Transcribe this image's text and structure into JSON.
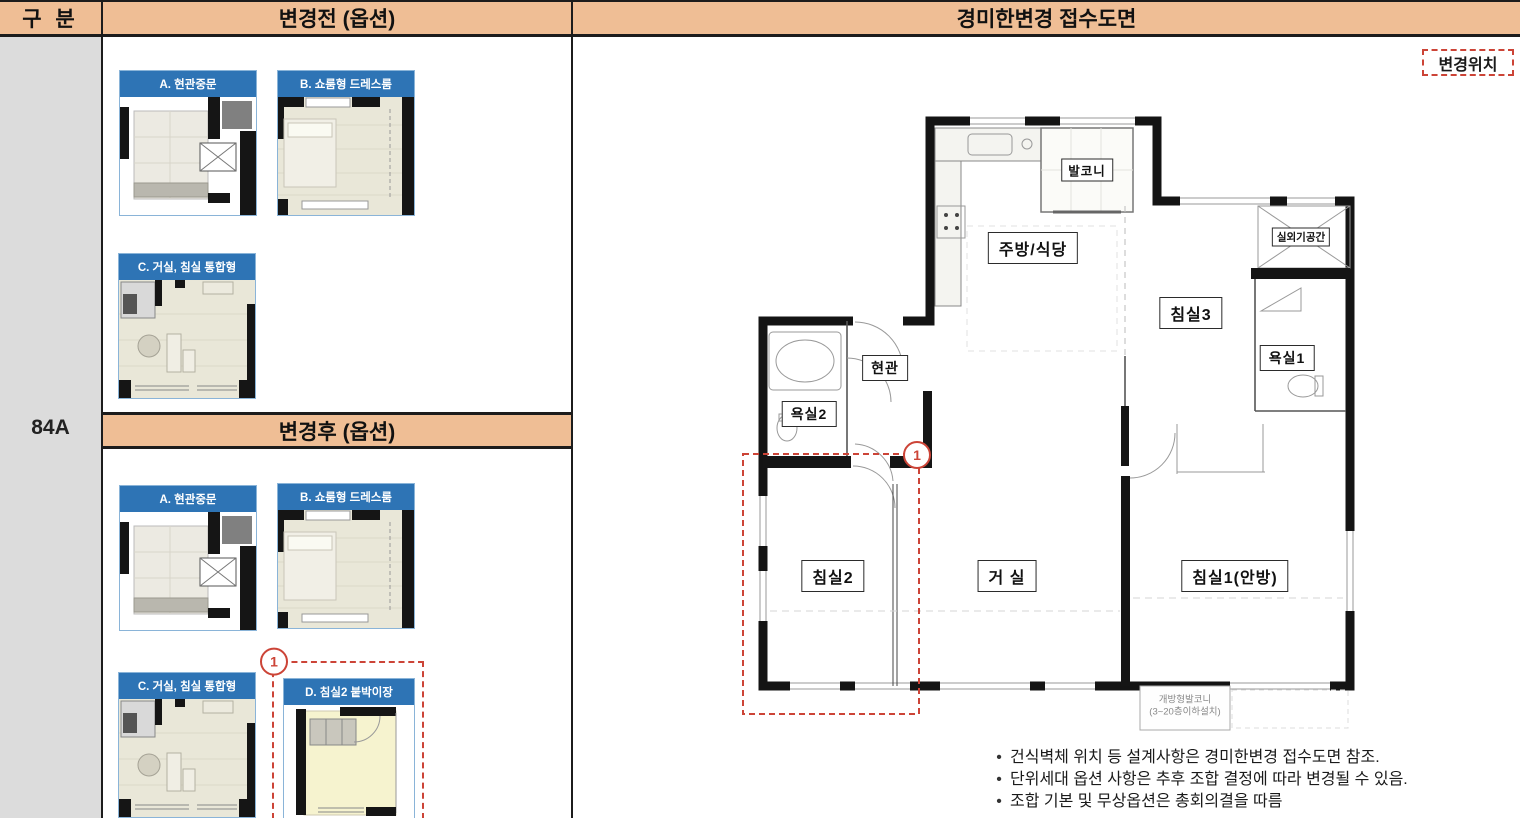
{
  "header": {
    "col_category": "구 분",
    "col_before": "변경전 (옵션)",
    "col_plan": "경미한변경 접수도면"
  },
  "unit": {
    "label": "84A"
  },
  "after_header": "변경후 (옵션)",
  "before_options": [
    {
      "label": "A. 현관중문"
    },
    {
      "label": "B. 쇼룸형 드레스룸"
    },
    {
      "label": "C. 거실, 침실 통합형"
    }
  ],
  "after_options": [
    {
      "label": "A. 현관중문"
    },
    {
      "label": "B. 쇼룸형 드레스룸"
    },
    {
      "label": "C. 거실, 침실 통합형"
    },
    {
      "label": "D. 침실2 붙박이장",
      "marker": "1"
    }
  ],
  "plan": {
    "badge": "변경위치",
    "marker": "1",
    "rooms": {
      "balcony": "발코니",
      "kitchen": "주방/식당",
      "bedroom3": "침실3",
      "outdoor_unit": "실외기공간",
      "entrance": "현관",
      "bath1": "욕실1",
      "bath2": "욕실2",
      "bedroom2": "침실2",
      "living": "거 실",
      "bedroom1": "침실1(안방)"
    },
    "open_balcony": {
      "line1": "개방형발코니",
      "line2": "(3~20층이하설치)"
    }
  },
  "notes": {
    "items": [
      {
        "text": "건식벽체 위치 등 설계사항은 경미한변경 접수도면 참조."
      },
      {
        "text": "단위세대 옵션 사항은 추후 조합 결정에 따라 변경될 수 있음."
      },
      {
        "text": "조합 기본 및 무상옵션은 총회의결을 따름"
      }
    ]
  },
  "colors": {
    "header_bg": "#efbe95",
    "category_bg": "#dcdcdc",
    "option_header_blue": "#2e74b5",
    "highlight_red": "#cc4437",
    "grid_border": "#1c1c1c"
  }
}
